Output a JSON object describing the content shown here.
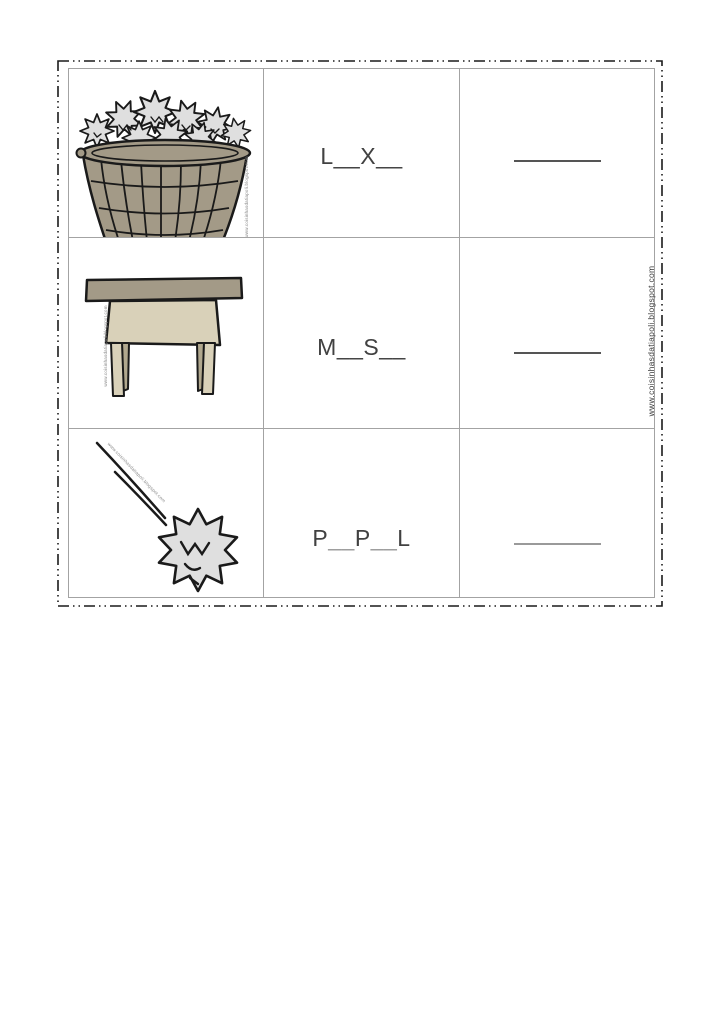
{
  "page": {
    "background": "#ffffff",
    "source_watermark": "www.coisinhasdatiapoli.blogspot.com"
  },
  "worksheet": {
    "type": "fill-in-the-missing-letters",
    "rows": [
      {
        "image": "wastebasket-full-of-crumpled-paper",
        "word": "L__X__",
        "underscore_color": "#414141",
        "line_color": "#555555",
        "answer_line": ""
      },
      {
        "image": "school-table",
        "word": "M__S__",
        "underscore_color": "#414141",
        "line_color": "#555555",
        "answer_line": ""
      },
      {
        "image": "crumpled-paper-ball-thrown",
        "word": "P__P__L",
        "underscore_color": "#9c9c9c",
        "line_color": "#9a9a9a",
        "answer_line": ""
      }
    ],
    "colors": {
      "ink": "#1a1a1a",
      "grid": "#a3a3a3",
      "text": "#414141",
      "taupe": "#a39a87",
      "cream": "#d9d1b9",
      "leg": "#c6bda3",
      "leg_shade": "#b1a88e",
      "paper": "#dfdfdf",
      "wm": "#8a8a8a"
    }
  }
}
